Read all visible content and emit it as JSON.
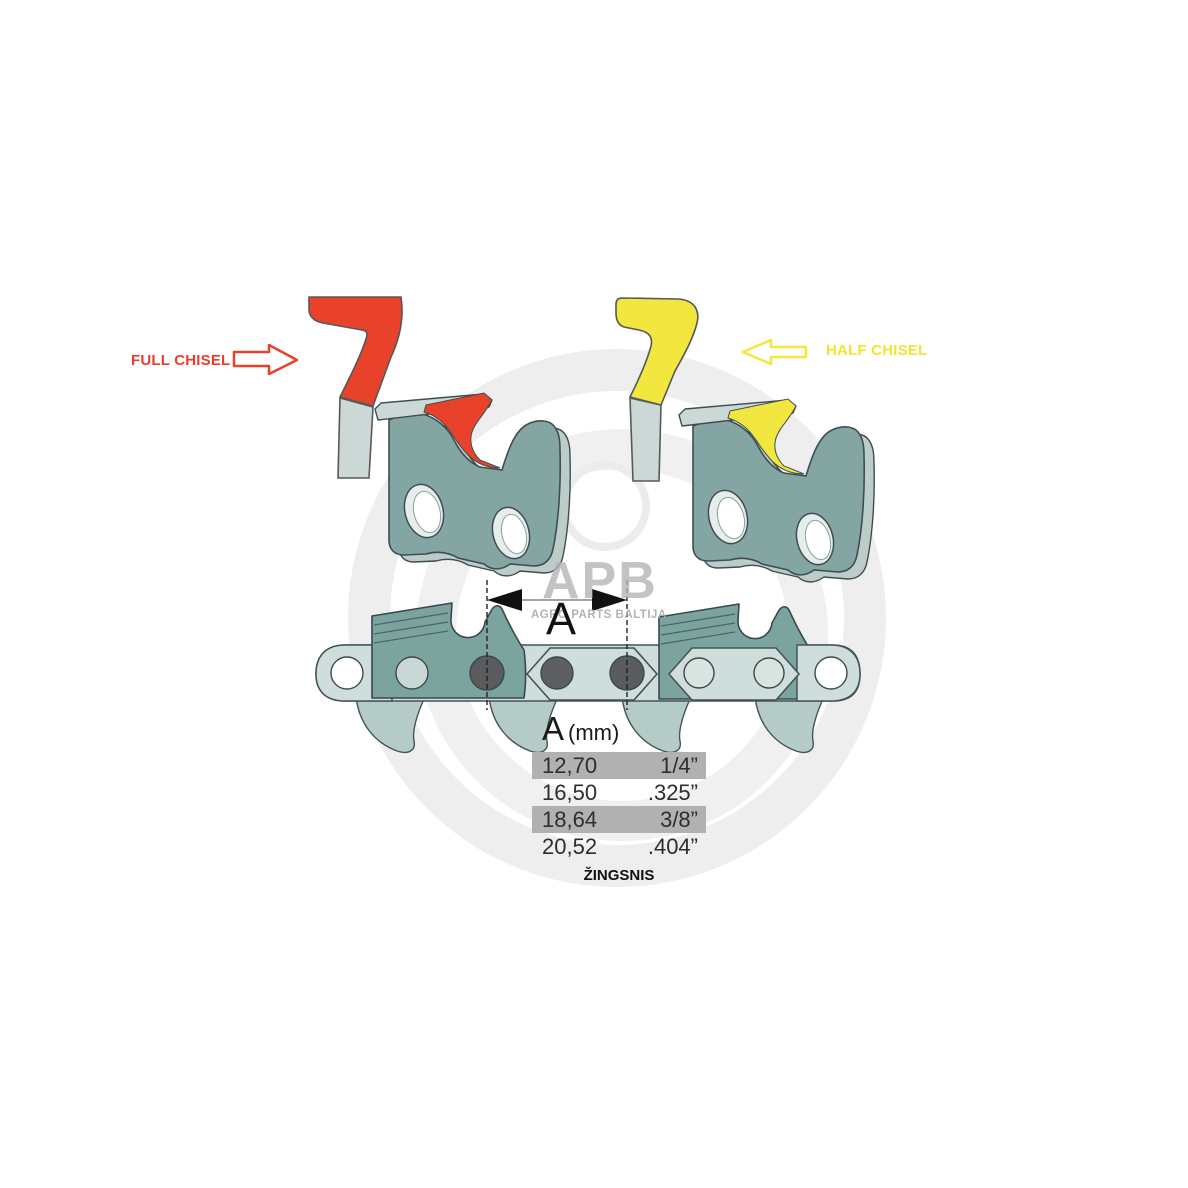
{
  "diagram": {
    "full_chisel_label": "FULL CHISEL",
    "half_chisel_label": "HALF CHISEL",
    "dimension_label": "A"
  },
  "watermark": {
    "logo_text": "APB",
    "subtitle": "AGRO PARTS BALTIJA"
  },
  "pitch_table": {
    "header_letter": "A",
    "header_unit": "(mm)",
    "caption": "ŽINGSNIS",
    "rows": [
      {
        "mm": "12,70",
        "inches": "1/4”"
      },
      {
        "mm": "16,50",
        "inches": ".325”"
      },
      {
        "mm": "18,64",
        "inches": "3/8”"
      },
      {
        "mm": "20,52",
        "inches": ".404”"
      }
    ]
  },
  "colors": {
    "full_chisel_accent": "#e8432a",
    "half_chisel_accent": "#f2e73e",
    "link_body": "#84a6a2",
    "link_side": "#bccdc9",
    "plate": "#ccd8d5",
    "chain_strap": "#cfdeda",
    "chain_cutter": "#7ca49f",
    "rivet_dark": "#595b5d",
    "outline": "#3f4d52",
    "table_highlight": "#b1b1b1"
  }
}
